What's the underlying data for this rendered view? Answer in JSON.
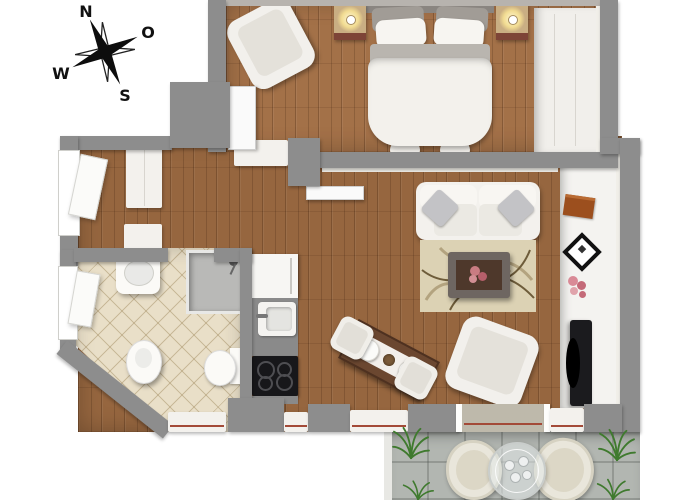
{
  "compass": {
    "n": "N",
    "o": "O",
    "s": "S",
    "w": "W"
  },
  "colors": {
    "wall": "#8d8d8d",
    "wall_light": "#b7b3ae",
    "wood_floor": "#96663f",
    "bath_tile": "#e9dfc8",
    "terrace_tile": "#b2b6b1",
    "furniture_white": "#f3f1ed",
    "window_line_red": "#a34a38",
    "plant_green": "#3f7a2e",
    "tv_black": "#1b1b1e",
    "dining_table_wood": "#6b4730",
    "nightstand_tan": "#c9ae83",
    "rug_beige": "#dcd2b4"
  }
}
